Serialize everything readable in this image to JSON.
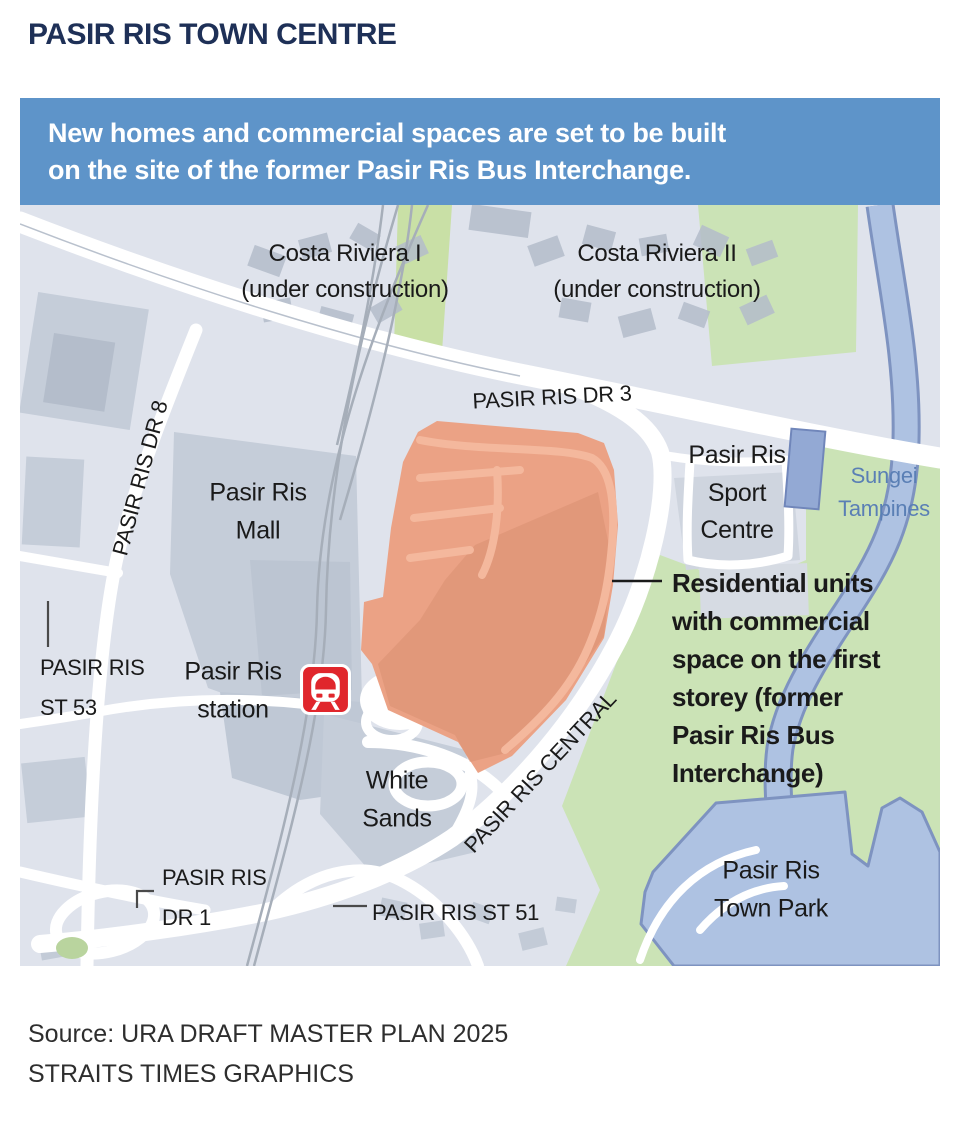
{
  "title": "PASIR RIS TOWN CENTRE",
  "banner": {
    "text": "New homes and commercial spaces are set to be built\non the site of the former Pasir Ris Bus Interchange."
  },
  "map": {
    "labels": {
      "costa_riviera_1": "Costa Riviera I\n(under construction)",
      "costa_riviera_2": "Costa Riviera II\n(under construction)",
      "pasir_ris_dr_3": "PASIR RIS DR 3",
      "pasir_ris_dr_8": "PASIR RIS DR 8",
      "pasir_ris_mall": "Pasir Ris\nMall",
      "pasir_ris_sport_centre": "Pasir Ris\nSport\nCentre",
      "sungei_tampines": "Sungei\nTampines",
      "pasir_ris_st_53": "PASIR RIS\nST 53",
      "pasir_ris_station": "Pasir Ris\nstation",
      "white_sands": "White\nSands",
      "pasir_ris_central": "PASIR RIS CENTRAL",
      "pasir_ris_town_park": "Pasir Ris\nTown Park",
      "pasir_ris_dr_1": "PASIR RIS\nDR 1",
      "pasir_ris_st_51": "PASIR RIS ST 51"
    },
    "annotation": "Residential units\nwith commercial\nspace on the first\nstorey (former\nPasir Ris Bus\nInterchange)",
    "station_icon": "mrt-train-icon"
  },
  "source": {
    "line1": "Source: URA DRAFT MASTER PLAN 2025",
    "line2": "STRAITS TIMES GRAPHICS"
  },
  "colors": {
    "title-navy": "#1e3057",
    "banner-bg": "#5e94c9",
    "banner-text": "#ffffff",
    "map-bg": "#dfe3ec",
    "road-white": "#ffffff",
    "building-gray": "#c5cdd9",
    "building-dark": "#b4bdcb",
    "site-orange": "#eba285",
    "site-orange-dark": "#db9173",
    "site-orange-road": "#f4b89d",
    "park-green": "#cbe3b6",
    "corridor-green": "#c9e0a6",
    "water-fill": "#aec2e2",
    "water-stroke": "#7e93c0",
    "rail-gray": "#a6aeb9",
    "mrt-red": "#e0262c",
    "label-black": "#1a1a1a",
    "water-label": "#5a7fb5",
    "leader-gray": "#4a4a4a",
    "source-text": "#2e2e2e"
  }
}
